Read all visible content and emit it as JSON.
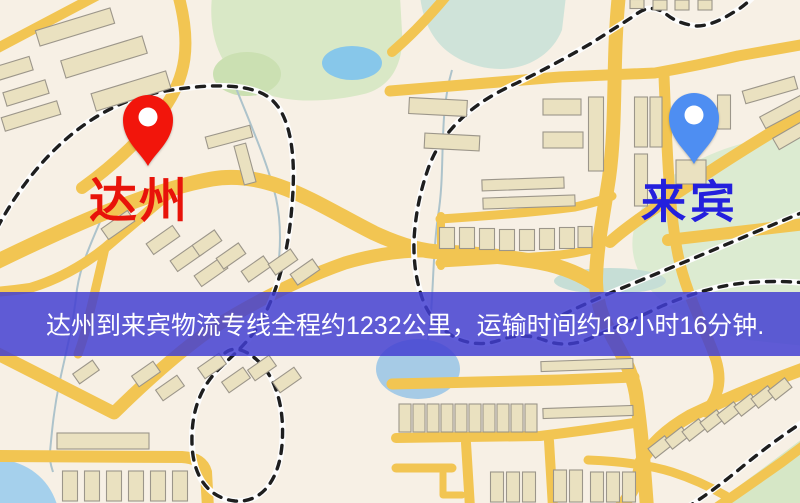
{
  "map": {
    "origin": {
      "name": "达州",
      "pin_color": "#f2150b",
      "label_color": "#e8130a"
    },
    "destination": {
      "name": "来宾",
      "pin_color": "#4e8ef2",
      "label_color": "#2420dd"
    },
    "banner": {
      "text": "达州到来宾物流专线全程约1232公里，运输时间约18小时16分钟.",
      "background_color": "#423ed2",
      "text_color": "#ffffff"
    },
    "route": {
      "origin": "达州",
      "destination": "来宾",
      "distance_text": "约1232公里",
      "duration_text": "约18小时16分钟"
    }
  }
}
